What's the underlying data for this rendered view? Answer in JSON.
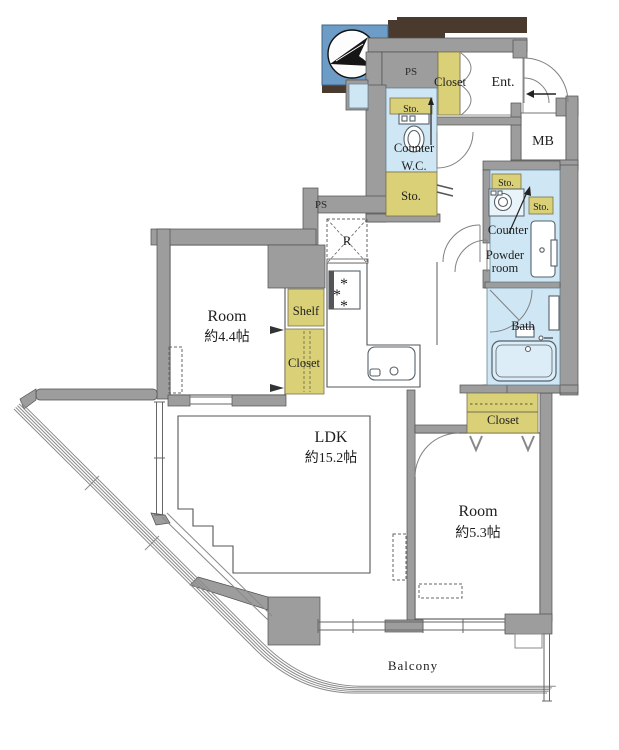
{
  "plan": {
    "compass": {
      "north": "N"
    },
    "shafts": {
      "ps_top": "PS",
      "ps_left": "PS"
    },
    "entrance": {
      "label": "Ent.",
      "closet": "Closet",
      "meter_box": "MB"
    },
    "wc": {
      "label": "W.C.",
      "counter": "Counter",
      "storage": "Sto."
    },
    "hall": {
      "storage": "Sto."
    },
    "kitchen": {
      "refrigerator": "R"
    },
    "powder_room": {
      "line1": "Powder",
      "line2": "room",
      "counter": "Counter",
      "storage_a": "Sto.",
      "storage_b": "Sto."
    },
    "bath": {
      "label": "Bath"
    },
    "room_left": {
      "name": "Room",
      "size": "約4.4帖",
      "shelf": "Shelf",
      "closet": "Closet"
    },
    "ldk": {
      "name": "LDK",
      "size": "約15.2帖"
    },
    "room_right": {
      "name": "Room",
      "size": "約5.3帖",
      "closet": "Closet"
    },
    "balcony": {
      "label": "Balcony"
    },
    "colors": {
      "wall": "#9d9d9d",
      "storage_yellow": "#d9d077",
      "wet_blue": "#cfe7f4",
      "compass_blue": "#6d9cc6",
      "shadow_brown": "#4a3a2d"
    }
  }
}
